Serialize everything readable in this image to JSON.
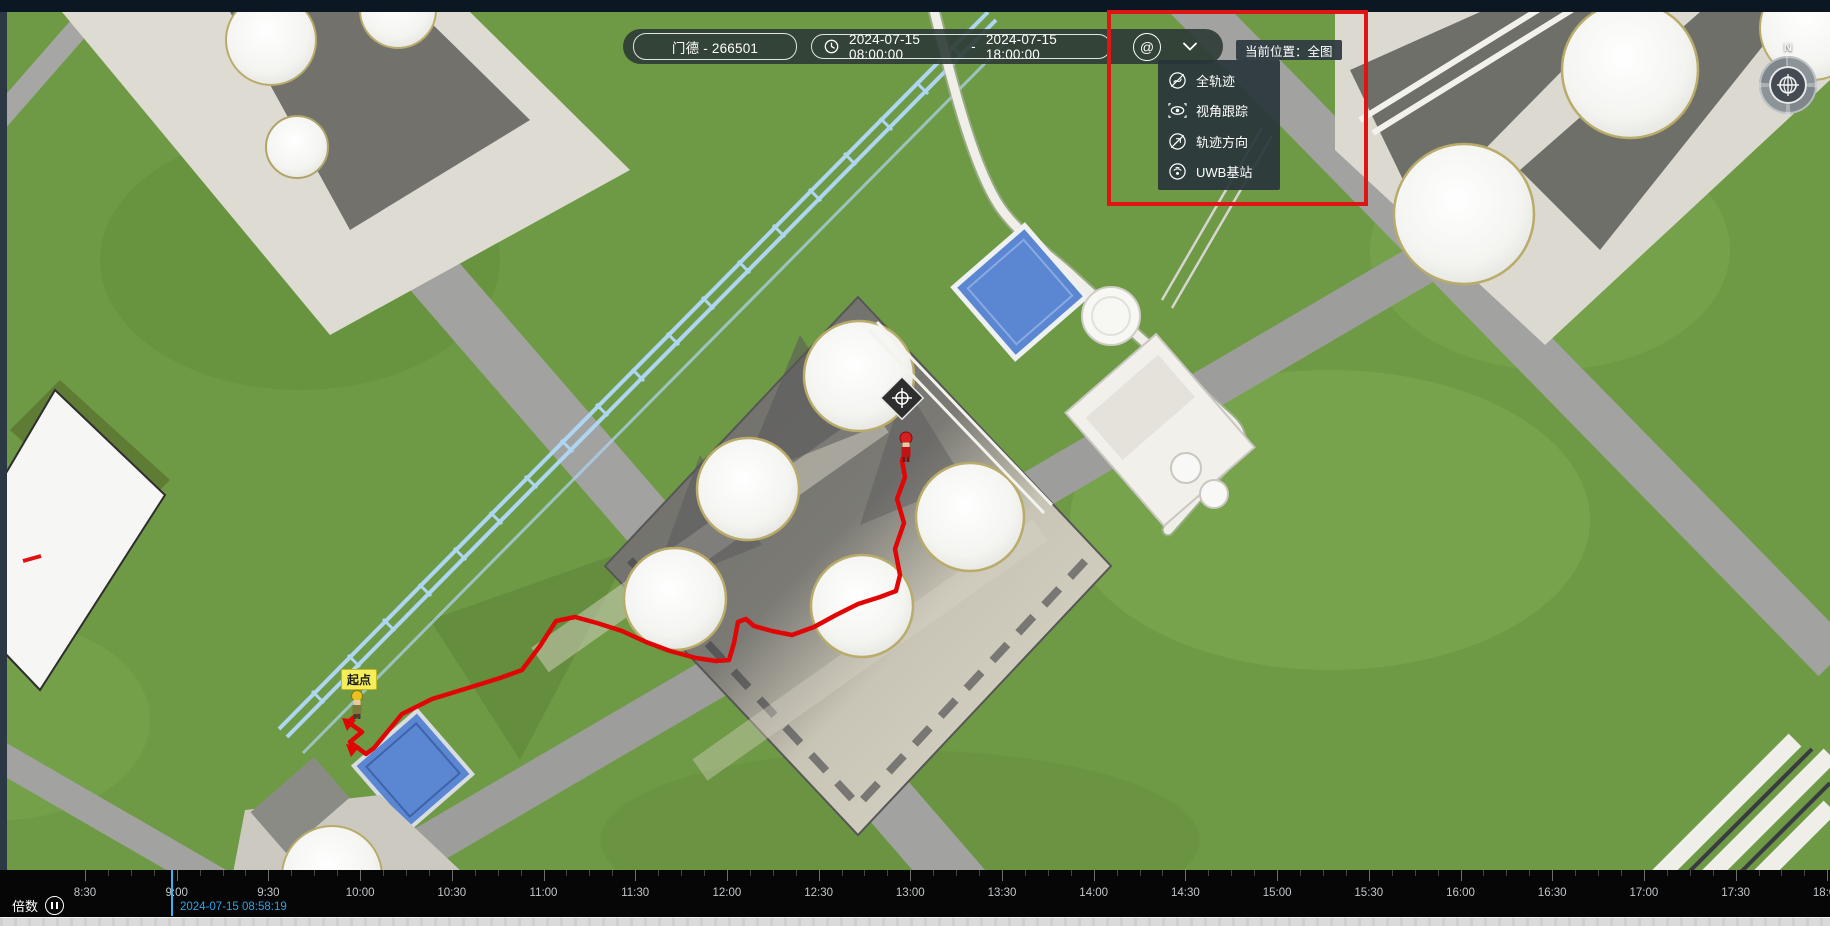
{
  "toolbar": {
    "person_value": "门德 - 266501",
    "time_start": "2024-07-15 08:00:00",
    "time_separator": "-",
    "time_end": "2024-07-15 18:00:00",
    "target_button_glyph": "@"
  },
  "location_tag": "当前位置：全图",
  "dropdown": {
    "items": [
      {
        "label": "全轨迹"
      },
      {
        "label": "视角跟踪"
      },
      {
        "label": "轨迹方向"
      },
      {
        "label": "UWB基站"
      }
    ]
  },
  "map": {
    "start_point_label": "起点",
    "compass_north": "N"
  },
  "timeline": {
    "speed_label": "倍数",
    "current_time": "2024-07-15 08:58:19",
    "ticks": [
      "8:30",
      "9:00",
      "9:30",
      "10:00",
      "10:30",
      "11:00",
      "11:30",
      "12:00",
      "12:30",
      "13:00",
      "13:30",
      "14:00",
      "14:30",
      "15:00",
      "15:30",
      "16:00",
      "16:30",
      "17:00",
      "17:30",
      "18:00"
    ],
    "tick_start_x": 85,
    "tick_spacing": 91.7
  },
  "trajectory": {
    "color": "#e00606",
    "points": [
      [
        358,
        714
      ],
      [
        348,
        722
      ],
      [
        362,
        732
      ],
      [
        350,
        742
      ],
      [
        366,
        754
      ],
      [
        374,
        748
      ],
      [
        402,
        714
      ],
      [
        432,
        699
      ],
      [
        468,
        688
      ],
      [
        500,
        678
      ],
      [
        522,
        670
      ],
      [
        540,
        646
      ],
      [
        556,
        621
      ],
      [
        575,
        617
      ],
      [
        597,
        623
      ],
      [
        622,
        631
      ],
      [
        646,
        642
      ],
      [
        670,
        651
      ],
      [
        696,
        658
      ],
      [
        716,
        661
      ],
      [
        729,
        660
      ],
      [
        734,
        643
      ],
      [
        738,
        622
      ],
      [
        746,
        619
      ],
      [
        754,
        626
      ],
      [
        772,
        631
      ],
      [
        792,
        635
      ],
      [
        814,
        627
      ],
      [
        836,
        615
      ],
      [
        858,
        604
      ],
      [
        880,
        597
      ],
      [
        896,
        591
      ],
      [
        900,
        575
      ],
      [
        895,
        549
      ],
      [
        904,
        523
      ],
      [
        897,
        499
      ],
      [
        905,
        477
      ],
      [
        902,
        461
      ],
      [
        906,
        450
      ]
    ]
  },
  "colors": {
    "grass": "#6f9a45",
    "road": "#a2a2a0",
    "pad": "#dedbd2",
    "annotation_red": "#df1414",
    "pond_blue": "#5b86d2",
    "cursor_blue": "#38b3f2",
    "pipe_rack_blue": "#aed6f2"
  }
}
